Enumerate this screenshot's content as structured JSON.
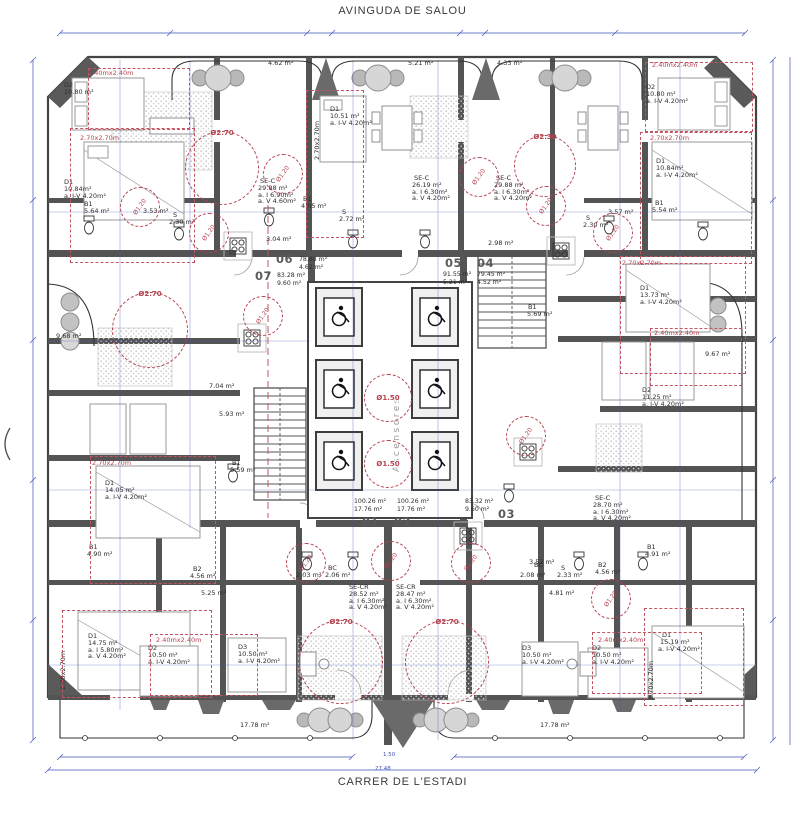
{
  "streets": {
    "top": "AVINGUDA DE SALOU",
    "bottom": "CARRER DE L'ESTADI"
  },
  "core": {
    "elevators_label": "Ascensores"
  },
  "icons": {
    "wheelchair": "wheelchair-access-symbol",
    "round_table": "round-table-with-chairs"
  },
  "colors": {
    "wall": "#545454",
    "dimension": "#3f51b5",
    "clearance_red": "#b54350"
  },
  "units": [
    {
      "no": "01",
      "lines": "100.26 m²\n17.76 m²",
      "nx": 362,
      "ny": 516,
      "lx": 354,
      "ly": 498
    },
    {
      "no": "02",
      "lines": "100.26 m²\n17.76 m²",
      "nx": 394,
      "ny": 516,
      "lx": 397,
      "ly": 498
    },
    {
      "no": "03",
      "lines": "83.32 m²\n9.60 m²",
      "nx": 498,
      "ny": 508,
      "lx": 465,
      "ly": 498
    },
    {
      "no": "04",
      "lines": "79.45 m²\n4.52 m²",
      "nx": 477,
      "ny": 257,
      "lx": 477,
      "ly": 271
    },
    {
      "no": "05",
      "lines": "91.55 m²\n5.21 m²",
      "nx": 445,
      "ny": 257,
      "lx": 443,
      "ly": 271
    },
    {
      "no": "06",
      "lines": "78.88 m²\n4.62 m²",
      "nx": 276,
      "ny": 253,
      "lx": 299,
      "ly": 256
    },
    {
      "no": "07",
      "lines": "83.28 m²\n9.60 m²",
      "nx": 255,
      "ny": 270,
      "lx": 277,
      "ly": 272
    }
  ],
  "labels": [
    [
      268,
      60,
      "4.62 m²",
      ""
    ],
    [
      408,
      60,
      "5.21 m²",
      ""
    ],
    [
      497,
      60,
      "4.33 m²",
      ""
    ],
    [
      64,
      82,
      "D2",
      ""
    ],
    [
      64,
      89,
      "10.80 m²",
      ""
    ],
    [
      88,
      70,
      "2.40mx2.40m",
      "red"
    ],
    [
      80,
      135,
      "2.70x2.70m",
      "red"
    ],
    [
      64,
      179,
      "D1",
      ""
    ],
    [
      64,
      186,
      "10.84m²",
      ""
    ],
    [
      64,
      193,
      "a. I-V 4.20m²",
      ""
    ],
    [
      84,
      201,
      "B1",
      ""
    ],
    [
      84,
      208,
      "5.64 m²",
      ""
    ],
    [
      143,
      208,
      "3.53 m²",
      ""
    ],
    [
      173,
      212,
      "S",
      ""
    ],
    [
      169,
      219,
      "2.30 m²",
      ""
    ],
    [
      260,
      178,
      "SE-C",
      ""
    ],
    [
      258,
      185,
      "29.88 m²",
      ""
    ],
    [
      258,
      192,
      "a. I 6.90m²",
      ""
    ],
    [
      258,
      198,
      "a. V 4.60m²",
      ""
    ],
    [
      303,
      196,
      "B1",
      ""
    ],
    [
      301,
      203,
      "4.05 m²",
      ""
    ],
    [
      342,
      209,
      "S",
      ""
    ],
    [
      339,
      216,
      "2.72 m²",
      ""
    ],
    [
      266,
      236,
      "3.04 m²",
      ""
    ],
    [
      330,
      106,
      "D1",
      ""
    ],
    [
      330,
      113,
      "10.51 m²",
      ""
    ],
    [
      330,
      120,
      "a. I-V 4.20m²",
      ""
    ],
    [
      314,
      160,
      "2.70x2.70m",
      "redv"
    ],
    [
      414,
      175,
      "SE-C",
      ""
    ],
    [
      412,
      182,
      "26.19 m²",
      ""
    ],
    [
      412,
      189,
      "a. I 6.30m²",
      ""
    ],
    [
      412,
      195,
      "a. V 4.20m²",
      ""
    ],
    [
      496,
      175,
      "SE-C",
      ""
    ],
    [
      494,
      182,
      "29.88 m²",
      ""
    ],
    [
      494,
      189,
      "a. I 6.30m²",
      ""
    ],
    [
      494,
      195,
      "a. V 4.20m²",
      ""
    ],
    [
      488,
      240,
      "2.98 m²",
      ""
    ],
    [
      528,
      304,
      "B1",
      ""
    ],
    [
      527,
      311,
      "5.69 m²",
      ""
    ],
    [
      652,
      62,
      "2.40mx2.40m",
      "red"
    ],
    [
      646,
      84,
      "D2",
      ""
    ],
    [
      646,
      91,
      "10.80 m²",
      ""
    ],
    [
      646,
      98,
      "a. I-V 4.20m²",
      ""
    ],
    [
      650,
      135,
      "2.70x2.70m",
      "red"
    ],
    [
      656,
      158,
      "D1",
      ""
    ],
    [
      656,
      165,
      "10.84m²",
      ""
    ],
    [
      656,
      172,
      "a. I-V 4.20m²",
      ""
    ],
    [
      655,
      200,
      "B1",
      ""
    ],
    [
      652,
      207,
      "5.54 m²",
      ""
    ],
    [
      608,
      209,
      "3.57 m²",
      ""
    ],
    [
      586,
      215,
      "S",
      ""
    ],
    [
      583,
      222,
      "2.30 m²",
      ""
    ],
    [
      622,
      260,
      "2.70x2.70m",
      "red"
    ],
    [
      640,
      285,
      "D1",
      ""
    ],
    [
      640,
      292,
      "13.73 m²",
      ""
    ],
    [
      640,
      299,
      "a. I-V 4.20m²",
      ""
    ],
    [
      654,
      330,
      "2.40mx2.40m",
      "red"
    ],
    [
      705,
      351,
      "9.67 m²",
      ""
    ],
    [
      642,
      387,
      "D2",
      ""
    ],
    [
      642,
      394,
      "11.25 m²",
      ""
    ],
    [
      642,
      401,
      "a. I-V 4.20m²",
      ""
    ],
    [
      595,
      495,
      "SE-C",
      ""
    ],
    [
      593,
      502,
      "28.70 m²",
      ""
    ],
    [
      593,
      509,
      "a. I 6.30m²",
      ""
    ],
    [
      593,
      515,
      "a. V 4.20m²",
      ""
    ],
    [
      56,
      333,
      "9.68 m²",
      ""
    ],
    [
      209,
      383,
      "7.04 m²",
      ""
    ],
    [
      219,
      411,
      "5.93 m²",
      ""
    ],
    [
      232,
      460,
      "B1",
      ""
    ],
    [
      230,
      467,
      "5.59 m²",
      ""
    ],
    [
      92,
      460,
      "2.70x2.70m",
      "red"
    ],
    [
      105,
      480,
      "D1",
      ""
    ],
    [
      105,
      487,
      "14.05 m²",
      ""
    ],
    [
      105,
      494,
      "a. I-V 4.20m²",
      ""
    ],
    [
      529,
      559,
      "3.52 m²",
      ""
    ],
    [
      349,
      584,
      "SE-CR",
      ""
    ],
    [
      349,
      591,
      "28.52 m²",
      ""
    ],
    [
      349,
      598,
      "a. I 6.30m²",
      ""
    ],
    [
      349,
      604,
      "a. V 4.20m²",
      ""
    ],
    [
      396,
      584,
      "SE-CR",
      ""
    ],
    [
      396,
      591,
      "28.47 m²",
      ""
    ],
    [
      396,
      598,
      "a. I 6.30m²",
      ""
    ],
    [
      396,
      604,
      "a. V 4.20m²",
      ""
    ],
    [
      201,
      590,
      "5.25 m²",
      ""
    ],
    [
      549,
      590,
      "4.81 m²",
      ""
    ],
    [
      89,
      544,
      "B1",
      ""
    ],
    [
      87,
      551,
      "4.90 m²",
      ""
    ],
    [
      193,
      566,
      "B2",
      ""
    ],
    [
      190,
      573,
      "4.56 m²",
      ""
    ],
    [
      300,
      565,
      "S",
      ""
    ],
    [
      296,
      572,
      "2.03 m²",
      ""
    ],
    [
      328,
      565,
      "BC",
      ""
    ],
    [
      325,
      572,
      "2.06 m²",
      ""
    ],
    [
      534,
      562,
      "BC",
      ""
    ],
    [
      520,
      572,
      "2.08 m²",
      ""
    ],
    [
      561,
      565,
      "S",
      ""
    ],
    [
      557,
      572,
      "2.33 m²",
      ""
    ],
    [
      598,
      562,
      "B2",
      ""
    ],
    [
      595,
      569,
      "4.56 m²",
      ""
    ],
    [
      647,
      544,
      "B1",
      ""
    ],
    [
      645,
      551,
      "4.91 m²",
      ""
    ],
    [
      60,
      690,
      "2.70x2.70m",
      "redv"
    ],
    [
      88,
      633,
      "D1",
      ""
    ],
    [
      88,
      640,
      "14.75 m²",
      ""
    ],
    [
      88,
      647,
      "a. I 5.80m²",
      ""
    ],
    [
      88,
      653,
      "a. V 4.20m²",
      ""
    ],
    [
      156,
      637,
      "2.40mx2.40m",
      "red"
    ],
    [
      148,
      645,
      "D2",
      ""
    ],
    [
      148,
      652,
      "10.50 m²",
      ""
    ],
    [
      148,
      659,
      "a. I-V 4.20m²",
      ""
    ],
    [
      238,
      644,
      "D3",
      ""
    ],
    [
      238,
      651,
      "10.50 m²",
      ""
    ],
    [
      238,
      658,
      "a. I-V 4.20m²",
      ""
    ],
    [
      522,
      645,
      "D3",
      ""
    ],
    [
      522,
      652,
      "10.50 m²",
      ""
    ],
    [
      522,
      659,
      "a. I-V 4.20m²",
      ""
    ],
    [
      598,
      637,
      "2.40mx2.40m",
      "red"
    ],
    [
      592,
      645,
      "D2",
      ""
    ],
    [
      592,
      652,
      "10.50 m²",
      ""
    ],
    [
      592,
      659,
      "a. I-V 4.20m²",
      ""
    ],
    [
      648,
      700,
      "2.70x2.70m",
      "redv"
    ],
    [
      662,
      632,
      "D1",
      ""
    ],
    [
      660,
      639,
      "15.19 m²",
      ""
    ],
    [
      658,
      646,
      "a. I-V 4.20m²",
      ""
    ],
    [
      240,
      722,
      "17.78 m²",
      ""
    ],
    [
      540,
      722,
      "17.78 m²",
      ""
    ],
    [
      383,
      752,
      "1.50",
      "dim"
    ],
    [
      375,
      766,
      "27.48",
      "dim"
    ]
  ],
  "circles": [
    {
      "x": 185,
      "y": 131,
      "d": 74,
      "label": "Ø2.70",
      "pos": "top"
    },
    {
      "x": 514,
      "y": 135,
      "d": 62,
      "label": "Ø2.30",
      "pos": "top"
    },
    {
      "x": 112,
      "y": 292,
      "d": 76,
      "label": "Ø2.70",
      "pos": "top"
    },
    {
      "x": 299,
      "y": 620,
      "d": 84,
      "label": "Ø2.70",
      "pos": "top"
    },
    {
      "x": 405,
      "y": 620,
      "d": 84,
      "label": "Ø2.70",
      "pos": "top"
    },
    {
      "x": 364,
      "y": 374,
      "d": 48,
      "label": "Ø1.50",
      "pos": "mid"
    },
    {
      "x": 364,
      "y": 440,
      "d": 48,
      "label": "Ø1.50",
      "pos": "mid"
    },
    {
      "x": 120,
      "y": 187,
      "d": 40,
      "label": "Ø1.20",
      "pos": "rot"
    },
    {
      "x": 189,
      "y": 213,
      "d": 40,
      "label": "Ø1.20",
      "pos": "rot"
    },
    {
      "x": 263,
      "y": 154,
      "d": 40,
      "label": "Ø1.20",
      "pos": "rot"
    },
    {
      "x": 459,
      "y": 157,
      "d": 40,
      "label": "Ø1.20",
      "pos": "rot"
    },
    {
      "x": 526,
      "y": 186,
      "d": 40,
      "label": "Ø1.20",
      "pos": "rot"
    },
    {
      "x": 593,
      "y": 213,
      "d": 40,
      "label": "Ø1.20",
      "pos": "rot"
    },
    {
      "x": 243,
      "y": 296,
      "d": 40,
      "label": "Ø1.20",
      "pos": "rot"
    },
    {
      "x": 506,
      "y": 416,
      "d": 40,
      "label": "Ø1.20",
      "pos": "rot"
    },
    {
      "x": 286,
      "y": 543,
      "d": 40,
      "label": "Ø1.20",
      "pos": "rot"
    },
    {
      "x": 371,
      "y": 541,
      "d": 40,
      "label": "Ø1.20",
      "pos": "rot"
    },
    {
      "x": 451,
      "y": 543,
      "d": 40,
      "label": "Ø1.20",
      "pos": "rot"
    },
    {
      "x": 591,
      "y": 579,
      "d": 40,
      "label": "Ø1.20",
      "pos": "rot"
    }
  ],
  "boxes": [
    [
      70,
      128,
      125,
      135
    ],
    [
      88,
      68,
      102,
      62
    ],
    [
      306,
      90,
      58,
      148
    ],
    [
      640,
      132,
      112,
      132
    ],
    [
      645,
      62,
      108,
      70
    ],
    [
      620,
      256,
      126,
      118
    ],
    [
      650,
      328,
      92,
      58
    ],
    [
      90,
      456,
      126,
      128
    ],
    [
      62,
      610,
      150,
      88
    ],
    [
      150,
      634,
      108,
      62
    ],
    [
      592,
      632,
      110,
      62
    ],
    [
      644,
      608,
      100,
      98
    ]
  ]
}
